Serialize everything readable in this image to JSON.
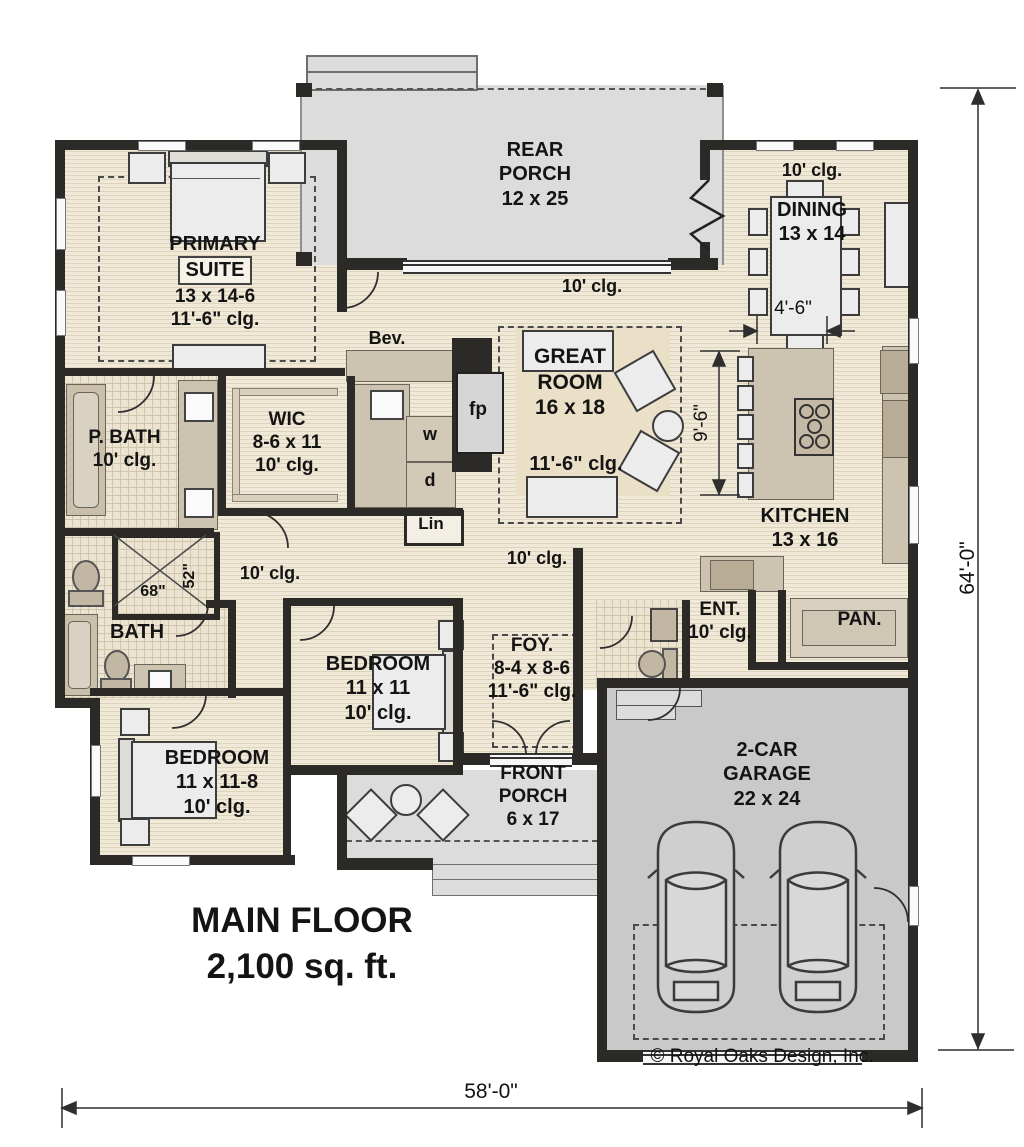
{
  "plan": {
    "title": [
      "MAIN FLOOR",
      "2,100 sq. ft."
    ],
    "copyright": "© Royal Oaks Design, Inc.",
    "overall_width": "58'-0\"",
    "overall_depth": "64'-0\""
  },
  "labels": {
    "rear_porch": [
      "REAR",
      "PORCH",
      "12 x 25"
    ],
    "porch_hall_clg": "10' clg.",
    "dining_clg": "10' clg.",
    "dining": [
      "DINING",
      "13 x 14"
    ],
    "primary_suite": [
      "PRIMARY",
      "SUITE",
      "13 x 14-6",
      "11'-6\" clg."
    ],
    "great_room": [
      "GREAT",
      "ROOM",
      "16 x 18"
    ],
    "great_room_clg": "11'-6\" clg.",
    "kitchen": [
      "KITCHEN",
      "13 x 16"
    ],
    "bev": "Bev.",
    "fireplace": "fp",
    "wic": [
      "WIC",
      "8-6 x 11",
      "10' clg."
    ],
    "washer": "w",
    "dryer": "d",
    "linen": "Lin",
    "p_bath": [
      "P. BATH",
      "10' clg."
    ],
    "shower_width": "68\"",
    "shower_depth": "52\"",
    "bath": "BATH",
    "hall_left_clg": "10' clg.",
    "hall_center_clg": "10' clg.",
    "bedroom_front": [
      "BEDROOM",
      "11 x 11",
      "10' clg."
    ],
    "foyer": [
      "FOY.",
      "8-4 x 8-6",
      "11'-6\" clg."
    ],
    "entry": [
      "ENT.",
      "10' clg."
    ],
    "pantry": "PAN.",
    "bedroom_left": [
      "BEDROOM",
      "11 x 11-8",
      "10' clg."
    ],
    "front_porch": [
      "FRONT",
      "PORCH",
      "6 x 17"
    ],
    "garage": [
      "2-CAR",
      "GARAGE",
      "22 x 24"
    ],
    "dim_dining": "4'-6\"",
    "dim_great_room": "9'-6\""
  },
  "colors": {
    "wall": "#2b2a27",
    "wood_floor": "#f1e9d7",
    "wood_line": "#ded4bd",
    "porch": "#dcdcdc",
    "garage": "#c9c9c9",
    "counter": "#cdc3b1",
    "tile_line": "#cfc6ae"
  }
}
